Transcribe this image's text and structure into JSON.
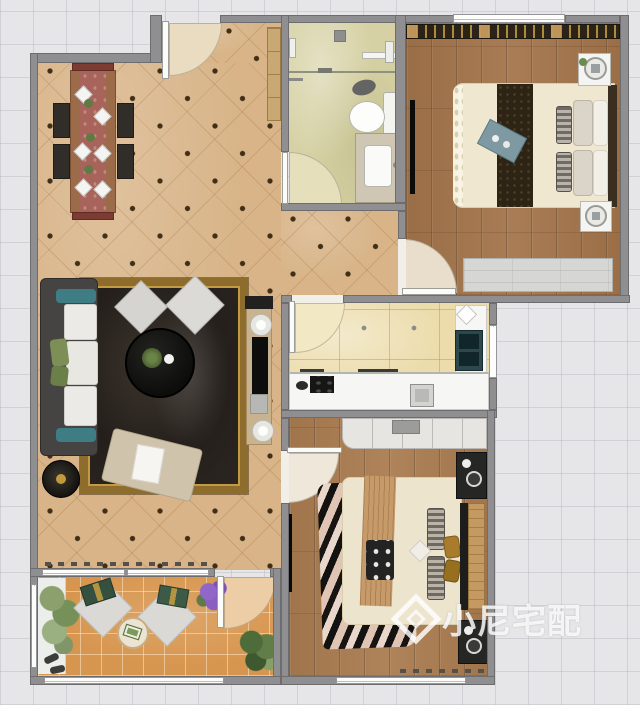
{
  "watermark": {
    "text": "小尼宅配",
    "logo_icon": "cube-diamond-logo"
  },
  "palette": {
    "background": "#e6e6e8",
    "wall": "#8f8f91",
    "living_floor": "#d8b488",
    "bath_floor": "#d6d1a4",
    "kitchen_floor": "#ecdcab",
    "master_floor": "#a3744a",
    "bedroom2_floor": "#aa7c50",
    "balcony_floor": "#d7964f",
    "rug": "#2b2622",
    "rug_border": "#8d6c2c",
    "sofa": "#464442",
    "accent_teal": "#3f7d85",
    "accent_green": "#7d8f57",
    "wood_furniture": "#9c6b4a"
  }
}
